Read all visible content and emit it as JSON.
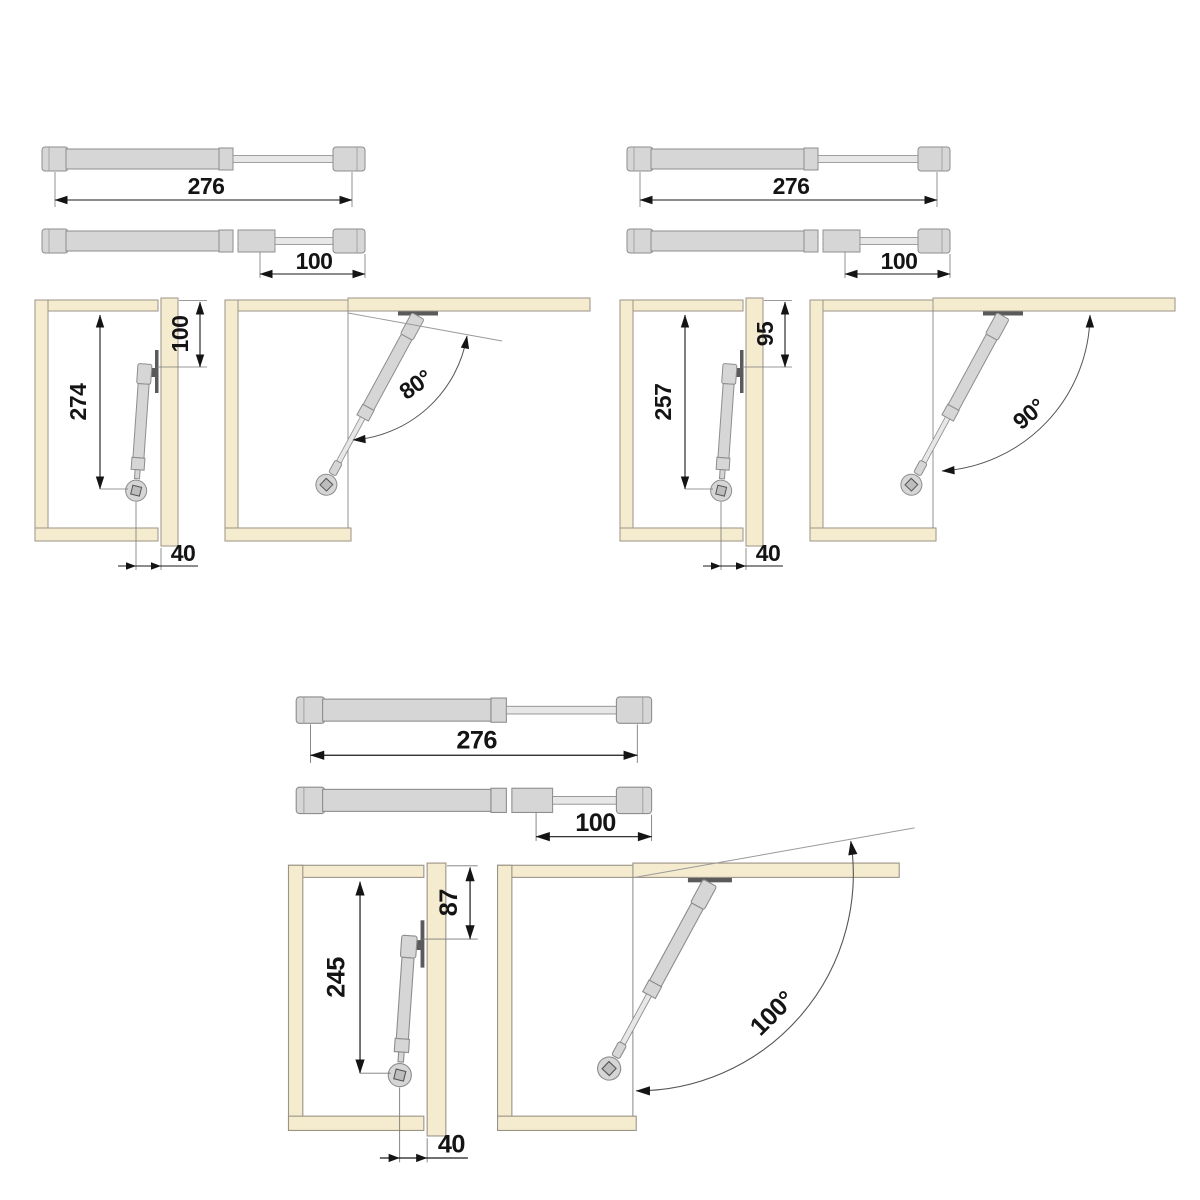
{
  "document": {
    "type": "technical-installation-diagram",
    "subject": "gas strut for lift-up cabinet doors: strut dimensions, mounting positions and opening angles"
  },
  "colors": {
    "background": "#ffffff",
    "wood": "#f5eccf",
    "wood_outline": "#9b9384",
    "metal": "#d6d6d6",
    "metal_outline": "#8d8d8d",
    "dimension_line": "#1a1a1a",
    "text": "#141414"
  },
  "figures": [
    {
      "name": "top-left",
      "strut_extended_length": "276",
      "strut_rod_stroke": "100",
      "installed_length": "274",
      "top_mount_offset": "100",
      "front_mount_offset": "40",
      "opening_angle": "80°"
    },
    {
      "name": "top-right",
      "strut_extended_length": "276",
      "strut_rod_stroke": "100",
      "installed_length": "257",
      "top_mount_offset": "95",
      "front_mount_offset": "40",
      "opening_angle": "90°"
    },
    {
      "name": "bottom-center",
      "strut_extended_length": "276",
      "strut_rod_stroke": "100",
      "installed_length": "245",
      "top_mount_offset": "87",
      "front_mount_offset": "40",
      "opening_angle": "100°"
    }
  ]
}
